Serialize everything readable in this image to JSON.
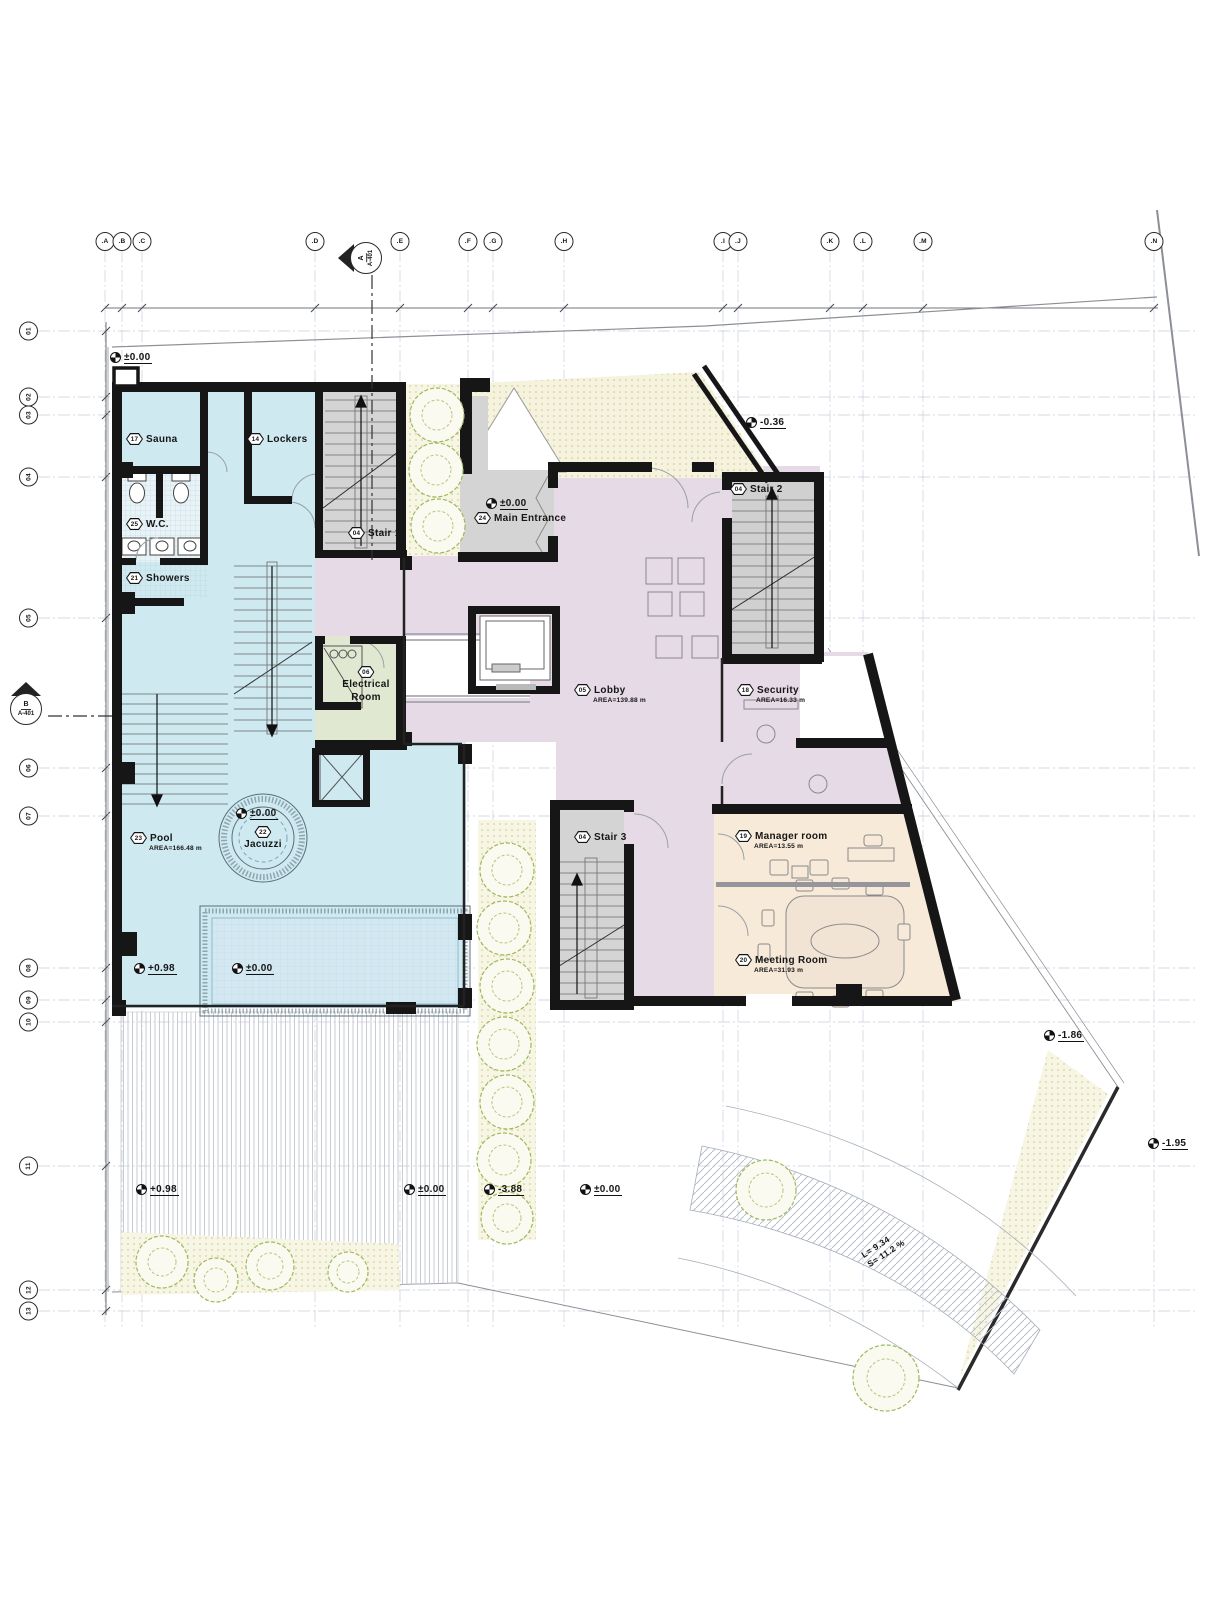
{
  "drawing": {
    "grid_columns": [
      {
        "label": ".A",
        "x": 105
      },
      {
        "label": ".B",
        "x": 122
      },
      {
        "label": ".C",
        "x": 142
      },
      {
        "label": ".D",
        "x": 315
      },
      {
        "label": ".E",
        "x": 400
      },
      {
        "label": ".F",
        "x": 468
      },
      {
        "label": ".G",
        "x": 493
      },
      {
        "label": ".H",
        "x": 564
      },
      {
        "label": ".I",
        "x": 723
      },
      {
        "label": ".J",
        "x": 738
      },
      {
        "label": ".K",
        "x": 830
      },
      {
        "label": ".L",
        "x": 863
      },
      {
        "label": ".M",
        "x": 923
      },
      {
        "label": ".N",
        "x": 1154
      }
    ],
    "grid_rows": [
      {
        "label": "01",
        "y": 331
      },
      {
        "label": "02",
        "y": 397
      },
      {
        "label": "03",
        "y": 415
      },
      {
        "label": "04",
        "y": 477
      },
      {
        "label": "05",
        "y": 618
      },
      {
        "label": "06",
        "y": 768
      },
      {
        "label": "07",
        "y": 816
      },
      {
        "label": "08",
        "y": 968
      },
      {
        "label": "09",
        "y": 1000
      },
      {
        "label": "10",
        "y": 1022
      },
      {
        "label": "11",
        "y": 1166
      },
      {
        "label": "12",
        "y": 1290
      },
      {
        "label": "13",
        "y": 1311
      }
    ],
    "top_dimensions": [
      {
        "value": "329",
        "x": 123
      },
      {
        "value": "609",
        "x": 228
      },
      {
        "value": "280",
        "x": 357
      },
      {
        "value": "220",
        "x": 434
      },
      {
        "value": "80",
        "x": 480
      },
      {
        "value": "225",
        "x": 528
      },
      {
        "value": "512",
        "x": 643
      },
      {
        "value": "53",
        "x": 730
      },
      {
        "value": "290",
        "x": 784
      },
      {
        "value": "105",
        "x": 846
      },
      {
        "value": "196",
        "x": 893
      },
      {
        "value": "748",
        "x": 1038
      }
    ],
    "left_dimensions": [
      {
        "value": "225",
        "y": 364
      },
      {
        "value": "18",
        "y": 406
      },
      {
        "value": "217",
        "y": 446
      },
      {
        "value": "460",
        "y": 548
      },
      {
        "value": "485",
        "y": 693
      },
      {
        "value": "160",
        "y": 792
      },
      {
        "value": "470",
        "y": 892
      },
      {
        "value": "105",
        "y": 984
      },
      {
        "value": "65",
        "y": 1011
      },
      {
        "value": "465",
        "y": 1094
      },
      {
        "value": "420",
        "y": 1228
      },
      {
        "value": "70",
        "y": 1300
      }
    ],
    "rooms": [
      {
        "num": "17",
        "name": "Sauna",
        "area": "",
        "x": 126,
        "y": 433
      },
      {
        "num": "14",
        "name": "Lockers",
        "area": "",
        "x": 247,
        "y": 433
      },
      {
        "num": "25",
        "name": "W.C.",
        "area": "",
        "x": 126,
        "y": 518
      },
      {
        "num": "21",
        "name": "Showers",
        "area": "",
        "x": 126,
        "y": 572
      },
      {
        "num": "04",
        "name": "Stair 1",
        "area": "",
        "x": 348,
        "y": 527
      },
      {
        "num": "04",
        "name": "Stair 2",
        "area": "",
        "x": 730,
        "y": 483
      },
      {
        "num": "04",
        "name": "Stair 3",
        "area": "",
        "x": 574,
        "y": 831
      },
      {
        "num": "24",
        "name": "Main Entrance",
        "area": "",
        "x": 474,
        "y": 512
      },
      {
        "num": "05",
        "name": "Lobby",
        "area": "AREA=139.88 m",
        "x": 574,
        "y": 684
      },
      {
        "num": "18",
        "name": "Security",
        "area": "AREA=16.33 m",
        "x": 737,
        "y": 684
      },
      {
        "num": "19",
        "name": "Manager room",
        "area": "AREA=13.55 m",
        "x": 735,
        "y": 830
      },
      {
        "num": "20",
        "name": "Meeting Room",
        "area": "AREA=31.93 m",
        "x": 735,
        "y": 954
      },
      {
        "num": "23",
        "name": "Pool",
        "area": "AREA=166.48 m",
        "x": 130,
        "y": 832
      }
    ],
    "rooms_vertical": [
      {
        "num": "06",
        "line1": "Electrical",
        "line2": "Room",
        "x": 366,
        "y": 666
      },
      {
        "num": "22",
        "line1": "Jacuzzi",
        "line2": "",
        "x": 263,
        "y": 826
      }
    ],
    "elevation_markers": [
      {
        "value": "±0.00",
        "x": 110,
        "y": 352
      },
      {
        "value": "-0.36",
        "x": 746,
        "y": 417
      },
      {
        "value": "±0.00",
        "x": 486,
        "y": 498
      },
      {
        "value": "±0.00",
        "x": 236,
        "y": 808
      },
      {
        "value": "+0.98",
        "x": 134,
        "y": 963
      },
      {
        "value": "±0.00",
        "x": 232,
        "y": 963
      },
      {
        "value": "+0.98",
        "x": 136,
        "y": 1184
      },
      {
        "value": "±0.00",
        "x": 404,
        "y": 1184
      },
      {
        "value": "-3.88",
        "x": 484,
        "y": 1184
      },
      {
        "value": "±0.00",
        "x": 580,
        "y": 1184
      },
      {
        "value": "-1.86",
        "x": 1044,
        "y": 1030
      },
      {
        "value": "-1.95",
        "x": 1148,
        "y": 1138
      }
    ],
    "notes": [
      {
        "text": "Entrance Ramp",
        "x": 486,
        "y": 437
      },
      {
        "text": "Void",
        "x": 424,
        "y": 664
      },
      {
        "text": "Void",
        "x": 806,
        "y": 682
      }
    ],
    "ramp_slope_note": {
      "line1": "L= 9.34",
      "line2": "S= 11.2 %"
    },
    "section_markers": [
      {
        "letter": "A",
        "sheet": "A-401"
      },
      {
        "letter": "B",
        "sheet": "A-401"
      }
    ],
    "colors": {
      "pool_zone": "#cfe9f1",
      "lobby_zone": "#e5dae6",
      "electrical_zone": "#e1e8d2",
      "office_zone": "#f8ead9",
      "stair_zone": "#d4d4d4",
      "sand": "#f7f5e3",
      "wall": "#161616",
      "water": "#d4e8f2"
    }
  }
}
